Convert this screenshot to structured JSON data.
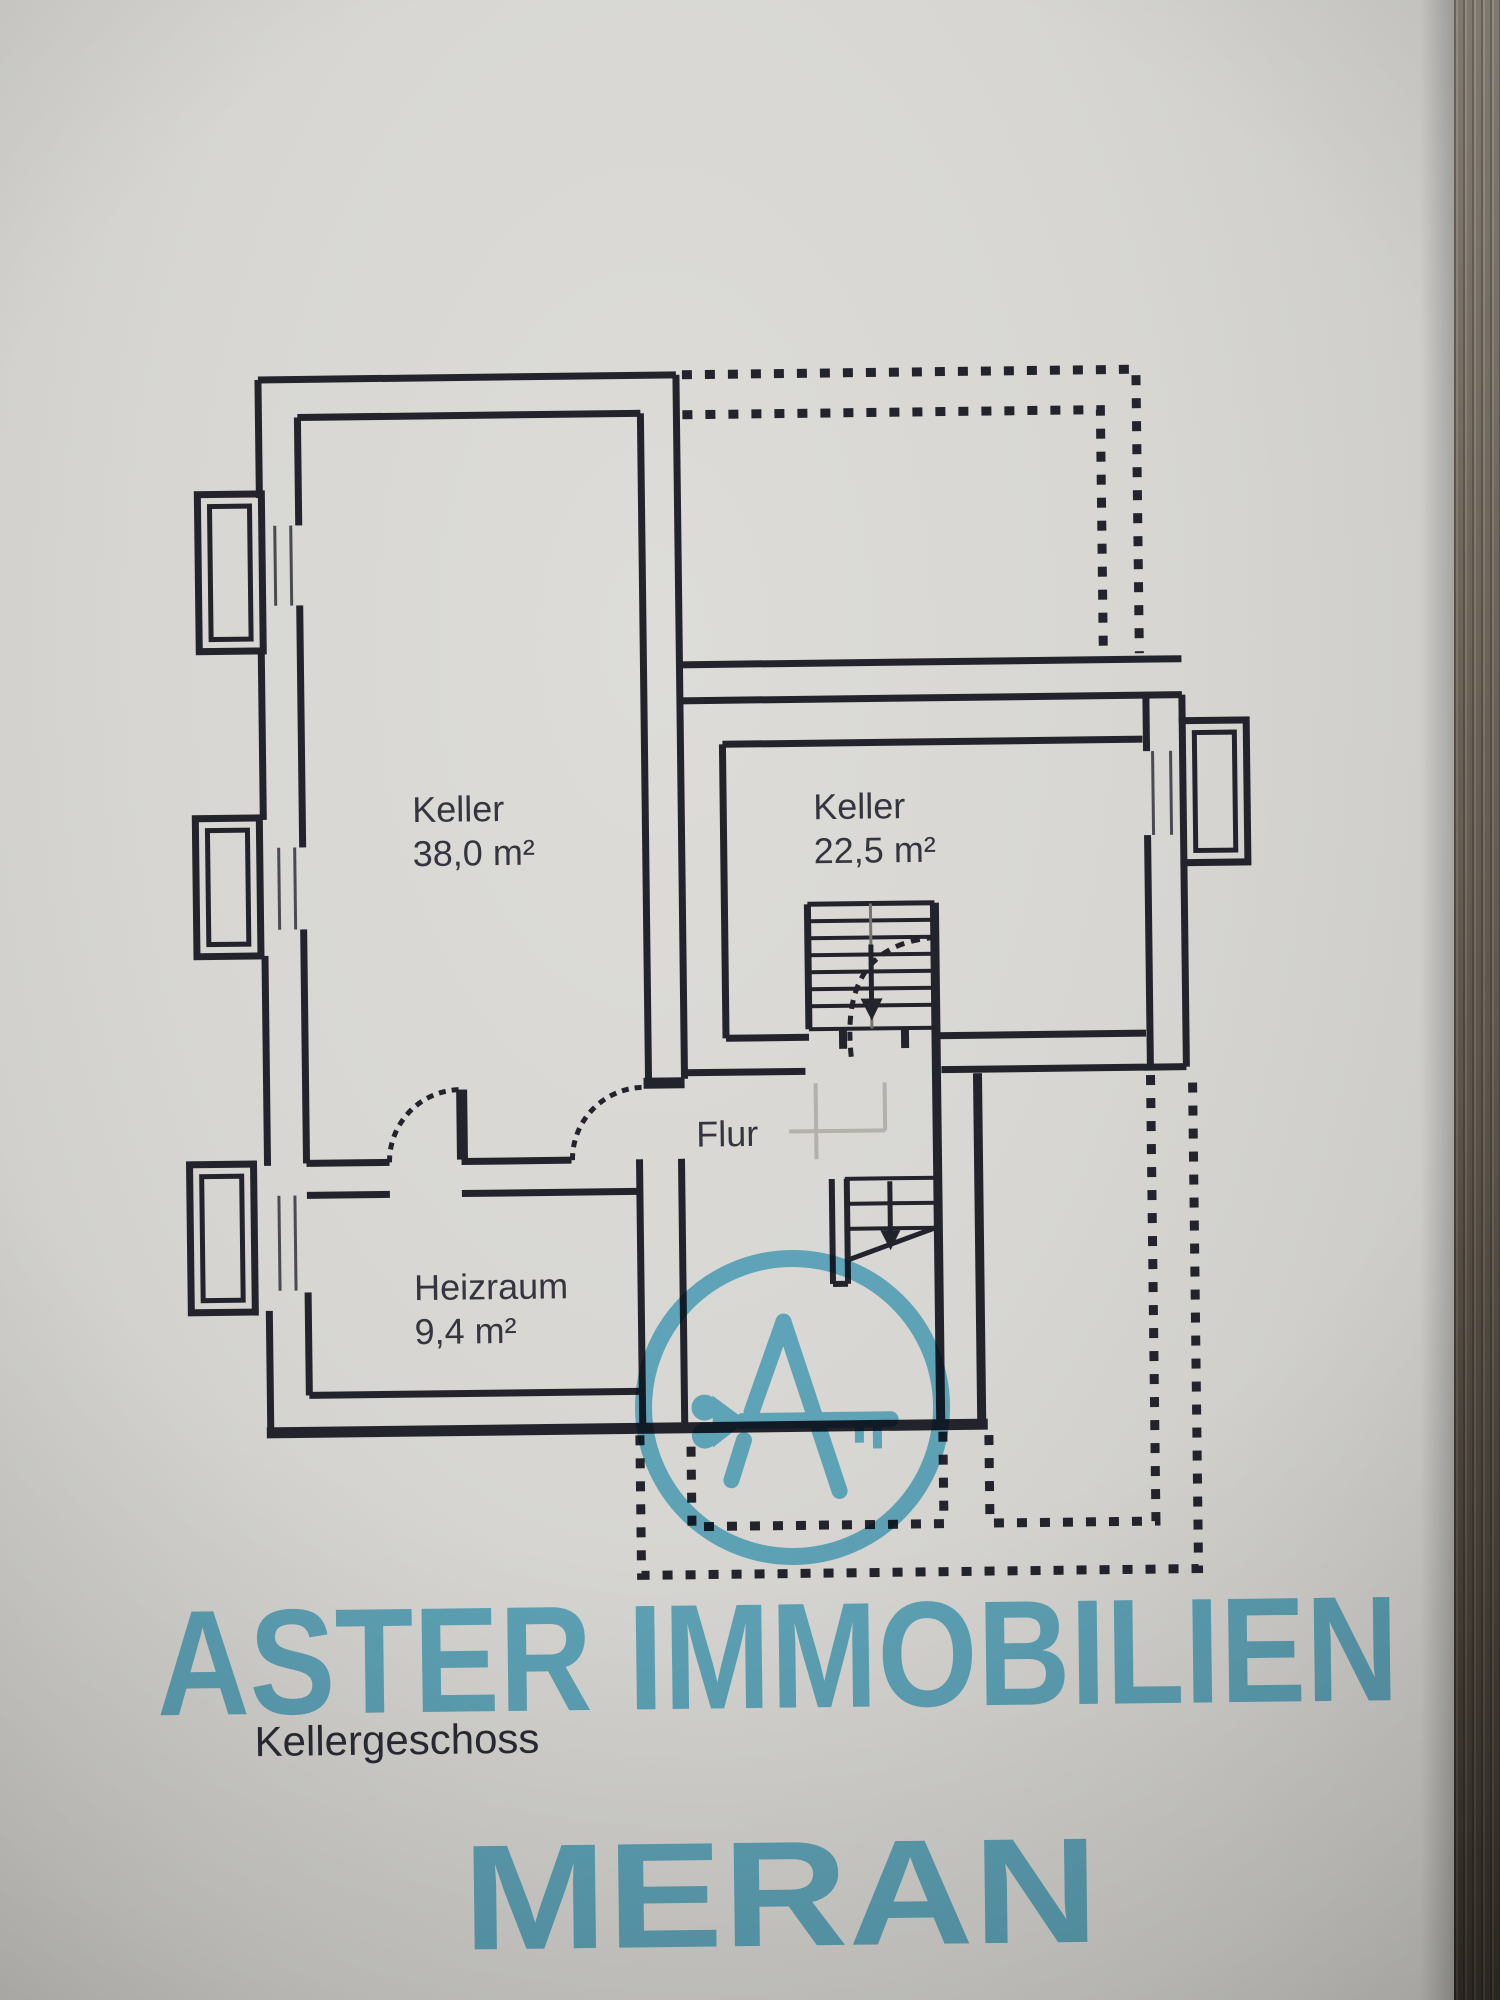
{
  "photo": {
    "description": "scan-photo of a paper floor plan lying on a dark wooden surface",
    "paper_color": "#d7d6d2",
    "line_color": "#23232b",
    "wood_edge_color_top": "#968e83",
    "wood_edge_color_bottom": "#38322b"
  },
  "plan": {
    "floor_title": "Kellergeschoss",
    "rooms": [
      {
        "id": "keller-left",
        "name": "Keller",
        "area": "38,0 m²"
      },
      {
        "id": "keller-right",
        "name": "Keller",
        "area": "22,5 m²"
      },
      {
        "id": "flur",
        "name": "Flur",
        "area": ""
      },
      {
        "id": "heizraum",
        "name": "Heizraum",
        "area": "9,4 m²"
      }
    ],
    "features": {
      "stairs": "two stair flights with down arrows",
      "dashed_outline": "upper-right and lower-right building footprint shown dotted",
      "windows": "three light wells on left wall, one on right wall"
    }
  },
  "watermark": {
    "company_line1": "ASTER IMMOBILIEN",
    "company_line2": "MERAN",
    "color": "#4fb4d6",
    "logo": "circle with stylized letter A whose crossbar is a key with heart-shaped bow"
  }
}
